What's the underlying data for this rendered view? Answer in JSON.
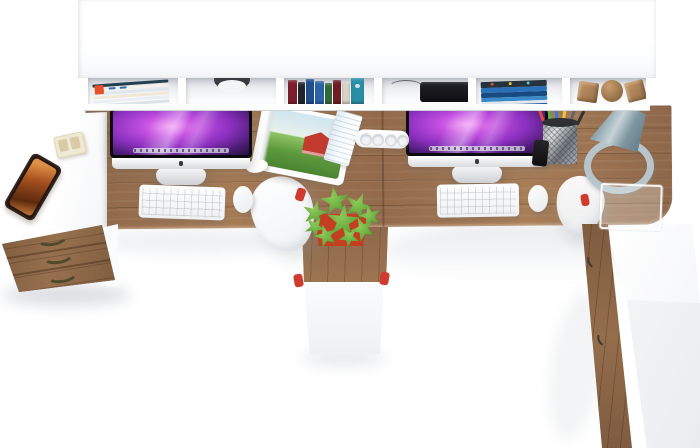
{
  "meta": {
    "description": "Top-down 3D product render of a two-person L-shaped computer workstation: wooden double desktop with white overhead cubby shelf, white return desk, three-drawer wooden pedestal, center cabinet with potted plant, and a tall wooden side cabinet",
    "background": "#ffffff"
  },
  "palette": {
    "floor": "#ffffff",
    "furniture_white": "#fdfdfe",
    "shelf_inner": "#d8dbe1",
    "wood": "#9b7351",
    "wood_dark": "#7d5a3e",
    "wood_light": "#a87e58",
    "drawer_wood": "#8d6748",
    "cabinet_wood": "#8a6347",
    "screen_bezel": "#0c0c10",
    "screen_purple": "#c24fe0",
    "screen_violet": "#8a2fbe",
    "screen_deep": "#241040",
    "aluminum": "#d8dadc",
    "pot_red": "#c33f1f",
    "plant_green": "#63a93c",
    "plant_green_light": "#8fca5a",
    "lamp_steel": "#7e97a2",
    "lamp_ring": "#b7c5ca",
    "accent_red": "#cf3b2f",
    "handle_olive": "#4f4a2a",
    "cabinet_handle": "#3f382e"
  },
  "shelf": {
    "label": "overhead cubby shelf unit",
    "cubbies": [
      {
        "label": "stack of magazines",
        "accent_tab": "#e8502a",
        "dash_color": "#2a6fb8",
        "strips": [
          "#24404e",
          "#f4f1ea",
          "#dfe7ec",
          "#f0e9d8",
          "#e9eef2",
          "#dce4ea"
        ]
      },
      {
        "label": "open cubby with cable grommet",
        "grommet_color": "#3a3b40"
      },
      {
        "label": "row of standing books",
        "spines": [
          "#7a1f2b",
          "#23262c",
          "#1f4f8f",
          "#2b63a8",
          "#2f6b3a",
          "#6e1e24",
          "#d8d3c8",
          "#2a8fa6"
        ]
      },
      {
        "label": "black media box with cable"
      },
      {
        "label": "stacked blue books",
        "spines": [
          "#26323c",
          "#2a6fb8",
          "#174a80",
          "#3a89c9",
          "#dfe8ee",
          "#2a5f9e"
        ],
        "dots": [
          "#d94f3a",
          "#e8c53a",
          "#58c5d9"
        ]
      },
      {
        "label": "wooden decor shapes: two cubes and a sphere"
      }
    ]
  },
  "desk": {
    "label": "wooden double desktop with rounded front corner",
    "seam_label": "center joint between desk halves",
    "return_label": "white return desk (left)"
  },
  "workstation_left": {
    "label": "left workstation",
    "monitor": "iMac with purple galaxy wallpaper",
    "keyboard": "white keyboard",
    "mouse": "white mouse",
    "magazine": "open magazine showing red barn in green field",
    "phone": "smartphone with warm orange screen",
    "organizer": "small beige desk organizer"
  },
  "workstation_right": {
    "label": "right workstation",
    "monitor": "iMac with purple galaxy wallpaper",
    "keyboard": "white keyboard",
    "mouse": "white mouse",
    "power_strip": {
      "label": "white power strip",
      "sockets": 4
    },
    "notebook": "pale blue notebook",
    "pen_cup": "metal mesh pen cup",
    "black_item": "small black gadget",
    "lamp": "steel-blue cone desk lamp with ring base",
    "tray": "clear acrylic tray"
  },
  "pens": [
    "#d94f3a",
    "#58b544",
    "#3a7bd9",
    "#e8c53a",
    "#60666c",
    "#2e3034"
  ],
  "plant": {
    "label": "green potted plant on center pedestal",
    "pot": "#c33f1f"
  },
  "storage": {
    "left_drawer_unit": {
      "label": "three-drawer wooden pedestal",
      "drawers": 3,
      "handle_color": "#4f4a2a"
    },
    "center_pedestal": {
      "label": "center cabinet between desks"
    },
    "right_cabinet": {
      "label": "tall wooden side cabinet",
      "handles": 2
    }
  },
  "chairs": {
    "left": "white chair tucked under left desk (top view)",
    "right": "white chair tucked under right desk (top view)",
    "accent": "#cf3b2f"
  }
}
